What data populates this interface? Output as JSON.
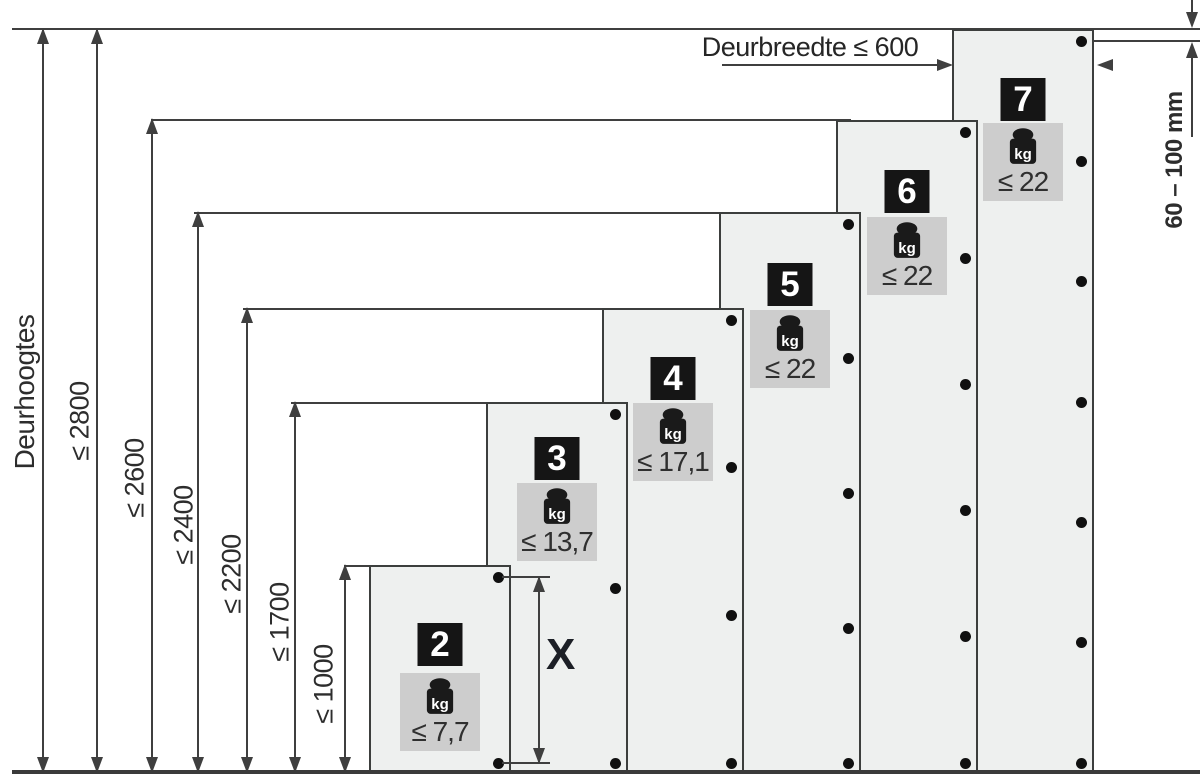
{
  "left_axis": {
    "title": "Deurhoogtes",
    "height_labels": [
      "≤ 2800",
      "≤ 2600",
      "≤ 2400",
      "≤ 2200",
      "≤ 1700",
      "≤ 1000"
    ]
  },
  "door_width_dim": {
    "label": "Deurbreedte ≤ 600"
  },
  "top_hinge_offset_dim": {
    "label": "60 – 100 mm"
  },
  "hinge_spacing_dim": {
    "label": "X"
  },
  "doors": [
    {
      "number": "2",
      "hinges": 2,
      "weight_unit": "kg",
      "weight_label": "≤ 7,7"
    },
    {
      "number": "3",
      "hinges": 3,
      "weight_unit": "kg",
      "weight_label": "≤ 13,7"
    },
    {
      "number": "4",
      "hinges": 4,
      "weight_unit": "kg",
      "weight_label": "≤ 17,1"
    },
    {
      "number": "5",
      "hinges": 5,
      "weight_unit": "kg",
      "weight_label": "≤ 22"
    },
    {
      "number": "6",
      "hinges": 6,
      "weight_unit": "kg",
      "weight_label": "≤ 22"
    },
    {
      "number": "7",
      "hinges": 7,
      "weight_unit": "kg",
      "weight_label": "≤ 22"
    }
  ],
  "colors": {
    "door_fill": "#eef0ef",
    "door_border": "#3c3e3d",
    "weight_box": "#cdcdcd",
    "number_plate": "#151515",
    "line": "#3f3f3f",
    "dot": "#101010",
    "text": "#2d2d2d"
  }
}
